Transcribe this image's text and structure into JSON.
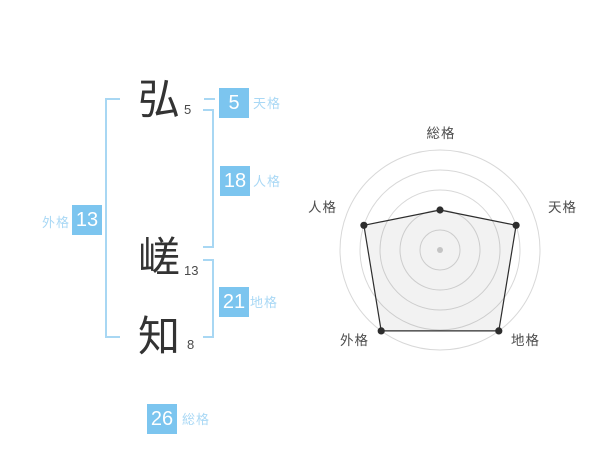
{
  "name_panel": {
    "characters": [
      {
        "char": "弘",
        "strokes": "5"
      },
      {
        "char": "嵯",
        "strokes": "13"
      },
      {
        "char": "知",
        "strokes": "8"
      }
    ],
    "badges": {
      "tenkaku": {
        "value": "5",
        "label": "天格"
      },
      "jinkaku": {
        "value": "18",
        "label": "人格"
      },
      "gaikaku": {
        "value": "13",
        "label": "外格"
      },
      "chikaku": {
        "value": "21",
        "label": "地格"
      },
      "soukaku": {
        "value": "26",
        "label": "総格"
      }
    },
    "colors": {
      "badge_bg": "#7cc5ef",
      "badge_text": "#ffffff",
      "kaku_label": "#a9d8f5",
      "bracket": "#a8d7f3",
      "kanji": "#333333",
      "stroke_count": "#4a4a4a"
    }
  },
  "chart_data": {
    "type": "radar",
    "title": "",
    "axes": [
      "総格",
      "天格",
      "地格",
      "外格",
      "人格"
    ],
    "values": [
      40,
      80,
      100,
      100,
      80
    ],
    "scale_max": 100,
    "rings": 5,
    "grid": "concentric-circles-no-spokes",
    "legend": "none",
    "colors": {
      "grid": "#d8d8d8",
      "polygon_stroke": "#2d2d2d",
      "polygon_fill": "rgba(0,0,0,0.05)",
      "vertex_dot": "#2d2d2d",
      "center_dot": "#c4c4c4",
      "label": "#4d4d4d"
    }
  }
}
